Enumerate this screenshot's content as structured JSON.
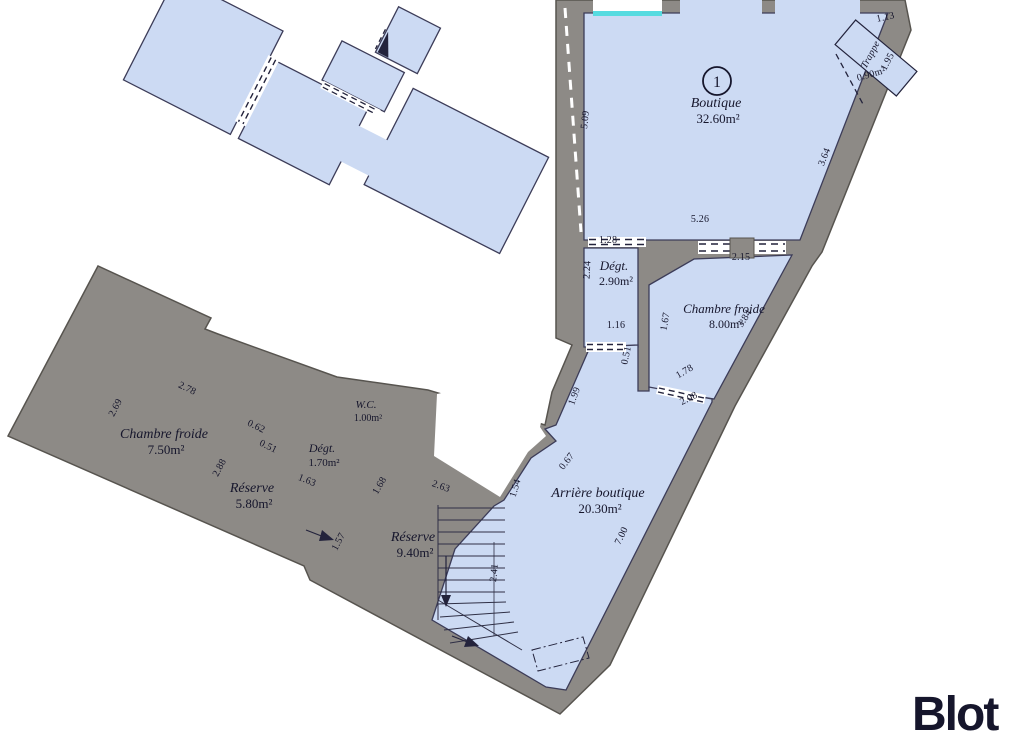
{
  "plan": {
    "colors": {
      "wall": "#8d8a86",
      "wall_edge": "#57544f",
      "room_fill": "#ccdaf3",
      "room_stroke": "#3c3c58",
      "line": "#23233c",
      "window": "#56dbe0",
      "brand": "#f2453d"
    },
    "unit_marker": {
      "number": "1",
      "x": 717,
      "y": 81,
      "r": 14
    },
    "rooms": [
      {
        "label": "Boutique",
        "area": "32.60m²",
        "x": 716,
        "y": 107,
        "fs": 14
      },
      {
        "label": "Dégt.",
        "area": "2.90m²",
        "x": 614,
        "y": 270,
        "fs": 13
      },
      {
        "label": "Chambre froide",
        "area": "8.00m²",
        "x": 724,
        "y": 313,
        "fs": 13
      },
      {
        "label": "Arrière boutique",
        "area": "20.30m²",
        "x": 598,
        "y": 497,
        "fs": 14
      },
      {
        "label": "Chambre froide",
        "area": "7.50m²",
        "x": 164,
        "y": 438,
        "fs": 14
      },
      {
        "label": "Réserve",
        "area": "5.80m²",
        "x": 252,
        "y": 492,
        "fs": 14
      },
      {
        "label": "Dégt.",
        "area": "1.70m²",
        "x": 322,
        "y": 452,
        "fs": 12
      },
      {
        "label": "W.C.",
        "area": "1.00m²",
        "x": 366,
        "y": 408,
        "fs": 11
      },
      {
        "label": "Réserve",
        "area": "9.40m²",
        "x": 413,
        "y": 541,
        "fs": 14
      }
    ],
    "annotations": [
      {
        "t": "Trappe",
        "x": 873,
        "y": 56,
        "r": -62,
        "fs": 9.5,
        "it": true
      },
      {
        "t": "0.90m²",
        "x": 872,
        "y": 77,
        "r": -16,
        "fs": 10.5,
        "it": false
      }
    ],
    "dimensions": [
      {
        "t": "5.09",
        "x": 588,
        "y": 120,
        "r": -84
      },
      {
        "t": "1.13",
        "x": 886,
        "y": 20,
        "r": -12
      },
      {
        "t": "1.95",
        "x": 890,
        "y": 63,
        "r": -62
      },
      {
        "t": "3.64",
        "x": 827,
        "y": 158,
        "r": -68
      },
      {
        "t": "5.26",
        "x": 700,
        "y": 222,
        "r": 0
      },
      {
        "t": "1.28",
        "x": 608,
        "y": 243,
        "r": 0
      },
      {
        "t": "2.24",
        "x": 590,
        "y": 270,
        "r": -87
      },
      {
        "t": "2.15",
        "x": 741,
        "y": 260,
        "r": 0
      },
      {
        "t": "1.67",
        "x": 668,
        "y": 322,
        "r": -80
      },
      {
        "t": "3.84",
        "x": 747,
        "y": 320,
        "r": -58
      },
      {
        "t": "1.16",
        "x": 616,
        "y": 328,
        "r": 0
      },
      {
        "t": "0.51",
        "x": 629,
        "y": 356,
        "r": -78
      },
      {
        "t": "1.78",
        "x": 686,
        "y": 374,
        "r": -30
      },
      {
        "t": "2.08",
        "x": 690,
        "y": 401,
        "r": -27
      },
      {
        "t": "1.99",
        "x": 577,
        "y": 397,
        "r": -70
      },
      {
        "t": "0.67",
        "x": 569,
        "y": 463,
        "r": -52
      },
      {
        "t": "1.54",
        "x": 518,
        "y": 489,
        "r": -73
      },
      {
        "t": "7.00",
        "x": 624,
        "y": 537,
        "r": -64
      },
      {
        "t": "2.41",
        "x": 497,
        "y": 573,
        "r": -84
      },
      {
        "t": "2.63",
        "x": 440,
        "y": 489,
        "r": 20
      },
      {
        "t": "1.68",
        "x": 382,
        "y": 487,
        "r": -60
      },
      {
        "t": "1.63",
        "x": 306,
        "y": 483,
        "r": 22
      },
      {
        "t": "1.57",
        "x": 341,
        "y": 543,
        "r": -62
      },
      {
        "t": "2.78",
        "x": 186,
        "y": 391,
        "r": 26
      },
      {
        "t": "2.69",
        "x": 118,
        "y": 409,
        "r": -62
      },
      {
        "t": "2.88",
        "x": 222,
        "y": 469,
        "r": -62
      },
      {
        "t": "0.62",
        "x": 255,
        "y": 429,
        "r": 26
      },
      {
        "t": "0.51",
        "x": 267,
        "y": 449,
        "r": 26
      }
    ],
    "logo": {
      "text": "Blot"
    }
  }
}
